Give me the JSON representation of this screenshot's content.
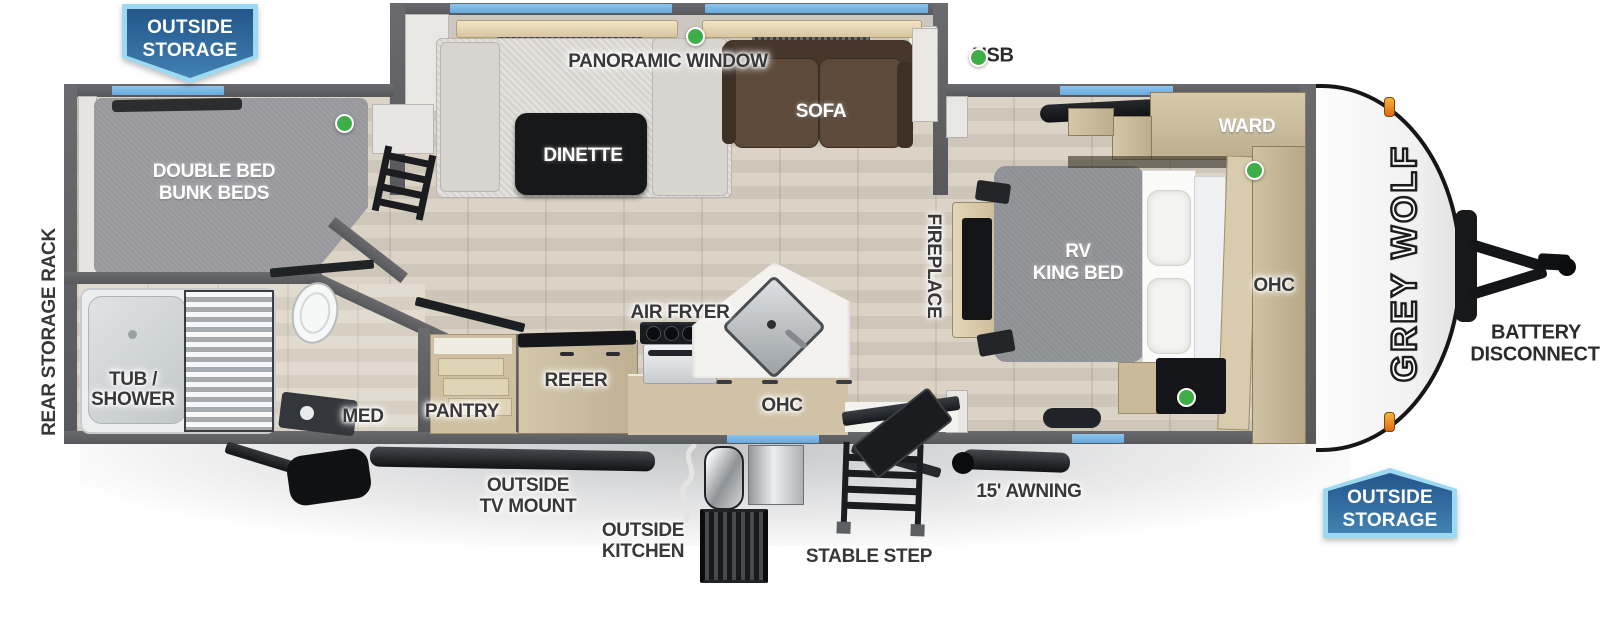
{
  "badges": {
    "top_left": {
      "line1": "OUTSIDE",
      "line2": "STORAGE"
    },
    "bottom_right": {
      "line1": "OUTSIDE",
      "line2": "STORAGE"
    }
  },
  "legend": {
    "usb": "USB"
  },
  "brand": {
    "name": "GREY WOLF"
  },
  "rooms": {
    "panoramic_window": "PANORAMIC WINDOW",
    "dinette": "DINETTE",
    "sofa": "SOFA",
    "bunk_line1": "DOUBLE BED",
    "bunk_line2": "BUNK BEDS",
    "tub_line1": "TUB /",
    "tub_line2": "SHOWER",
    "med": "MED",
    "pantry": "PANTRY",
    "refer": "REFER",
    "air_fryer": "AIR FRYER",
    "ohc_kitchen": "OHC",
    "fireplace": "FIREPLACE",
    "bed_line1": "RV",
    "bed_line2": "KING BED",
    "ward": "WARD",
    "ohc_bedroom": "OHC"
  },
  "exterior": {
    "rear_rack": "REAR STORAGE RACK",
    "battery_line1": "BATTERY",
    "battery_line2": "DISCONNECT",
    "tv_mount_line1": "OUTSIDE",
    "tv_mount_line2": "TV MOUNT",
    "outside_kitchen_line1": "OUTSIDE",
    "outside_kitchen_line2": "KITCHEN",
    "stable_step": "STABLE STEP",
    "awning": "15' AWNING"
  },
  "colors": {
    "wall": "#5e5f62",
    "window_blue": "#74b7e8",
    "usb_green": "#3fae49",
    "badge_border": "#9ddaf2",
    "badge_fill": "#2d639a",
    "marker_orange": "#f09c2a",
    "floor_wood": "#d5cdc0"
  }
}
